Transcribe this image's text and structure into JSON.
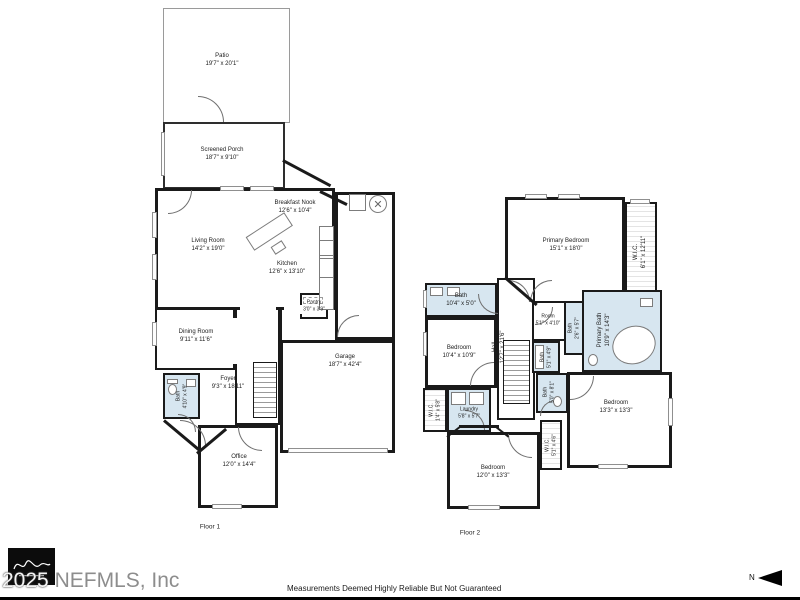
{
  "colors": {
    "wall": "#1a1a1a",
    "bath_fill": "#d7e6f0",
    "copyright_gray": "#8d8d8d"
  },
  "icons": {
    "water_heater_glyph": "✕"
  },
  "floor1": {
    "label": "Floor 1",
    "rooms": {
      "patio": {
        "name": "Patio",
        "dims": "19'7\" x 20'1\""
      },
      "screened_porch": {
        "name": "Screened Porch",
        "dims": "18'7\" x 9'10\""
      },
      "breakfast_nook": {
        "name": "Breakfast Nook",
        "dims": "12'6\" x 10'4\""
      },
      "living_room": {
        "name": "Living Room",
        "dims": "14'2\" x 19'0\""
      },
      "kitchen": {
        "name": "Kitchen",
        "dims": "12'6\" x 13'10\""
      },
      "pantry": {
        "name": "Pantry",
        "dims": "3'0\" x 3'9\""
      },
      "dining_room": {
        "name": "Dining Room",
        "dims": "9'11\" x 11'6\""
      },
      "garage": {
        "name": "Garage",
        "dims": "18'7\" x 42'4\""
      },
      "foyer": {
        "name": "Foyer",
        "dims": "9'3\" x 18'11\""
      },
      "bath": {
        "name": "Bath",
        "dims": "4'10\" x 4'9\""
      },
      "office": {
        "name": "Office",
        "dims": "12'0\" x 14'4\""
      }
    }
  },
  "floor2": {
    "label": "Floor 2",
    "rooms": {
      "primary_bedroom": {
        "name": "Primary Bedroom",
        "dims": "15'1\" x 18'0\""
      },
      "wic_primary": {
        "name": "W.I.C.",
        "dims": "6'1\" x 12'11\""
      },
      "primary_bath": {
        "name": "Primary Bath",
        "dims": "10'9\" x 14'3\""
      },
      "bath_hall": {
        "name": "Bath",
        "dims": "10'4\" x 5'0\""
      },
      "bedroom_left": {
        "name": "Bedroom",
        "dims": "10'4\" x 10'9\""
      },
      "hall": {
        "name": "Hall",
        "dims": "12'7\" x 21'6\""
      },
      "room": {
        "name": "Room",
        "dims": "5'1\" x 4'10\""
      },
      "bath_wc": {
        "name": "Bath",
        "dims": "2'6\" x 5'7\""
      },
      "bath_mid": {
        "name": "Bath",
        "dims": "5'1\" x 4'9\""
      },
      "bath_lower": {
        "name": "Bath",
        "dims": "5'0\" x 8'1\""
      },
      "laundry": {
        "name": "Laundry",
        "dims": "5'8\" x 5'7\""
      },
      "wic_left": {
        "name": "W.I.C.",
        "dims": "1'4\" x 5'8\""
      },
      "wic_right": {
        "name": "W.I.C.",
        "dims": "5'1\" x 4'6\""
      },
      "bedroom_bottom": {
        "name": "Bedroom",
        "dims": "12'0\" x 13'3\""
      },
      "bedroom_right": {
        "name": "Bedroom",
        "dims": "13'3\" x 13'3\""
      }
    }
  },
  "footer": {
    "copyright_year": "2025",
    "copyright_org": "NEFMLS, Inc",
    "disclaimer": "Measurements Deemed Highly Reliable But Not Guaranteed",
    "north_label": "N"
  }
}
